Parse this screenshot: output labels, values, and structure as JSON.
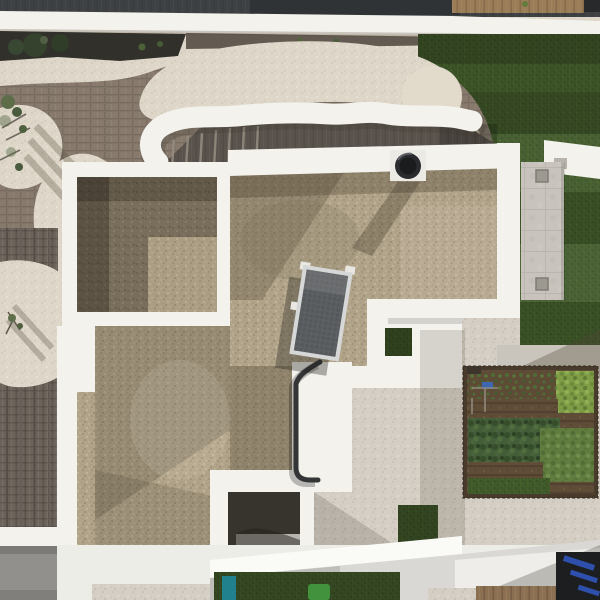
{
  "scene": {
    "description": "Top-down aerial drone photograph of a modern white flat-roof villa with gravel roof terraces, curved sculptural wall, artificial lawn, paver path, rooftop vegetable garden, solar panel and vent",
    "objects": {
      "neighbor_roof": "dark neighboring roof strip",
      "boundary_wall": "white boundary wall band",
      "planting_bed": "dark planting bed with shrubs",
      "lawn": "artificial turf lawn with mowing stripes",
      "brick_paving": "organic-shaped clay brick paving",
      "cream_gravel": "cream decorative gravel yard",
      "ribbon_wall": "curved white sculptural wall",
      "sunken_patio": "sunken dark block patio with steps",
      "main_roof": "main gravel roof with white parapets",
      "room_a": "upper-left gravel roof light-well",
      "solar_panel": "tilted photovoltaic panel",
      "vent_cap": "round black roof vent",
      "drain_pipe": "dark drain pipe",
      "paver_path": "concrete paver walkway with drains",
      "garden": "raised vegetable garden bed",
      "courtyard": "small shaded lower courtyard",
      "lower_roofs": "lower-level white roof planes",
      "pool_opening": "dark opening with blue cover below",
      "wood_deck": "wooden deck strip",
      "tree": "small tree with shadow"
    },
    "colors": {
      "parapet_white": "#f3f2ed",
      "white_bright": "#fafaf7",
      "white_soft": "#ebe9e3",
      "cream": "#ded7c8",
      "gravel_main": "#b0a287",
      "gravel_dark": "#776c59",
      "gravel_ground": "#d4cec4",
      "brick": "#8e8174",
      "brick_dark": "#6a6158",
      "paving_dark": "#5e564f",
      "neighbor_dark": "#3b3e40",
      "wood_top": "#9a7c55",
      "lawn_green": "#3d5626",
      "planting_dark": "#2e2c26",
      "sunken_gray": "#57504a",
      "paver_gray": "#c7c3bc",
      "concrete": "#8f8e8a",
      "patio_gray": "#c9c4bb",
      "solar_dark": "#55585b",
      "solar_frame": "#d6d7d7",
      "vent_black": "#26272a",
      "pipe_dark": "#303134",
      "soil": "#5c4a34",
      "leaf_dark": "#3f5a33",
      "leaf_bright": "#7d9b44",
      "leaf_mid": "#5d7a3c",
      "blue_accent": "#3b63b0",
      "teal_object": "#1d7f8a",
      "green_object": "#3f8f3a",
      "wood_floor": "#8a6e4f",
      "opening_dark": "#191a1c",
      "blue_tarp": "#2e57c4",
      "courtyard_floor": "#b7b4ae",
      "shadow": "rgba(55,47,35,0.3)"
    }
  }
}
